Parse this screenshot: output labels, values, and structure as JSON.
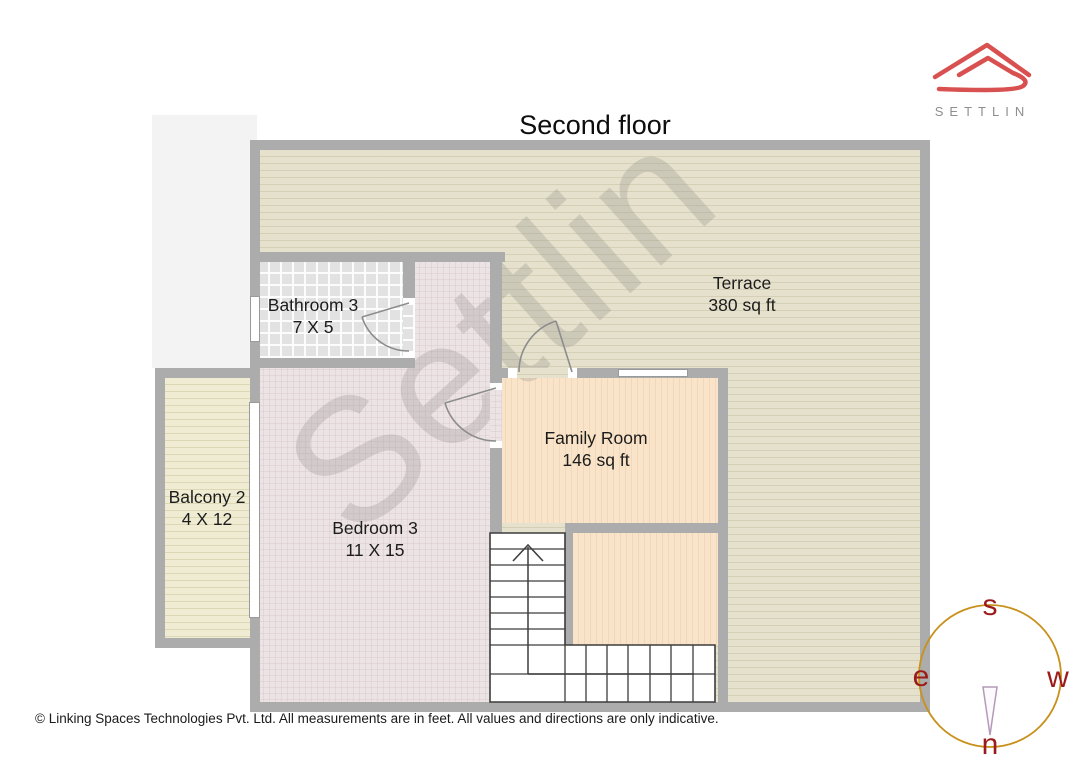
{
  "title": "Second floor",
  "brand": {
    "name": "SETTLIN"
  },
  "watermark": "Settlin",
  "rooms": {
    "terrace": {
      "name": "Terrace",
      "dims": "380 sq ft"
    },
    "bathroom": {
      "name": "Bathroom 3",
      "dims": "7 X 5"
    },
    "family": {
      "name": "Family Room",
      "dims": "146 sq ft"
    },
    "bedroom": {
      "name": "Bedroom 3",
      "dims": "11 X 15"
    },
    "balcony": {
      "name": "Balcony 2",
      "dims": "4 X 12"
    }
  },
  "compass": {
    "top": "s",
    "left": "e",
    "right": "w",
    "bottom": "n"
  },
  "footer": "© Linking Spaces Technologies Pvt. Ltd. All measurements are in feet. All values and directions are only indicative.",
  "colors": {
    "accent_red": "#d95050",
    "wall_gray": "#acacac",
    "terrace_floor": "#e5e1cc",
    "bedroom_floor": "#ece3e5",
    "bathroom_floor": "#e2e2e2",
    "family_floor": "#f9e4c9",
    "balcony_floor": "#efecd3",
    "compass_ring": "#c8911c",
    "compass_letters": "#9b1b1b"
  }
}
